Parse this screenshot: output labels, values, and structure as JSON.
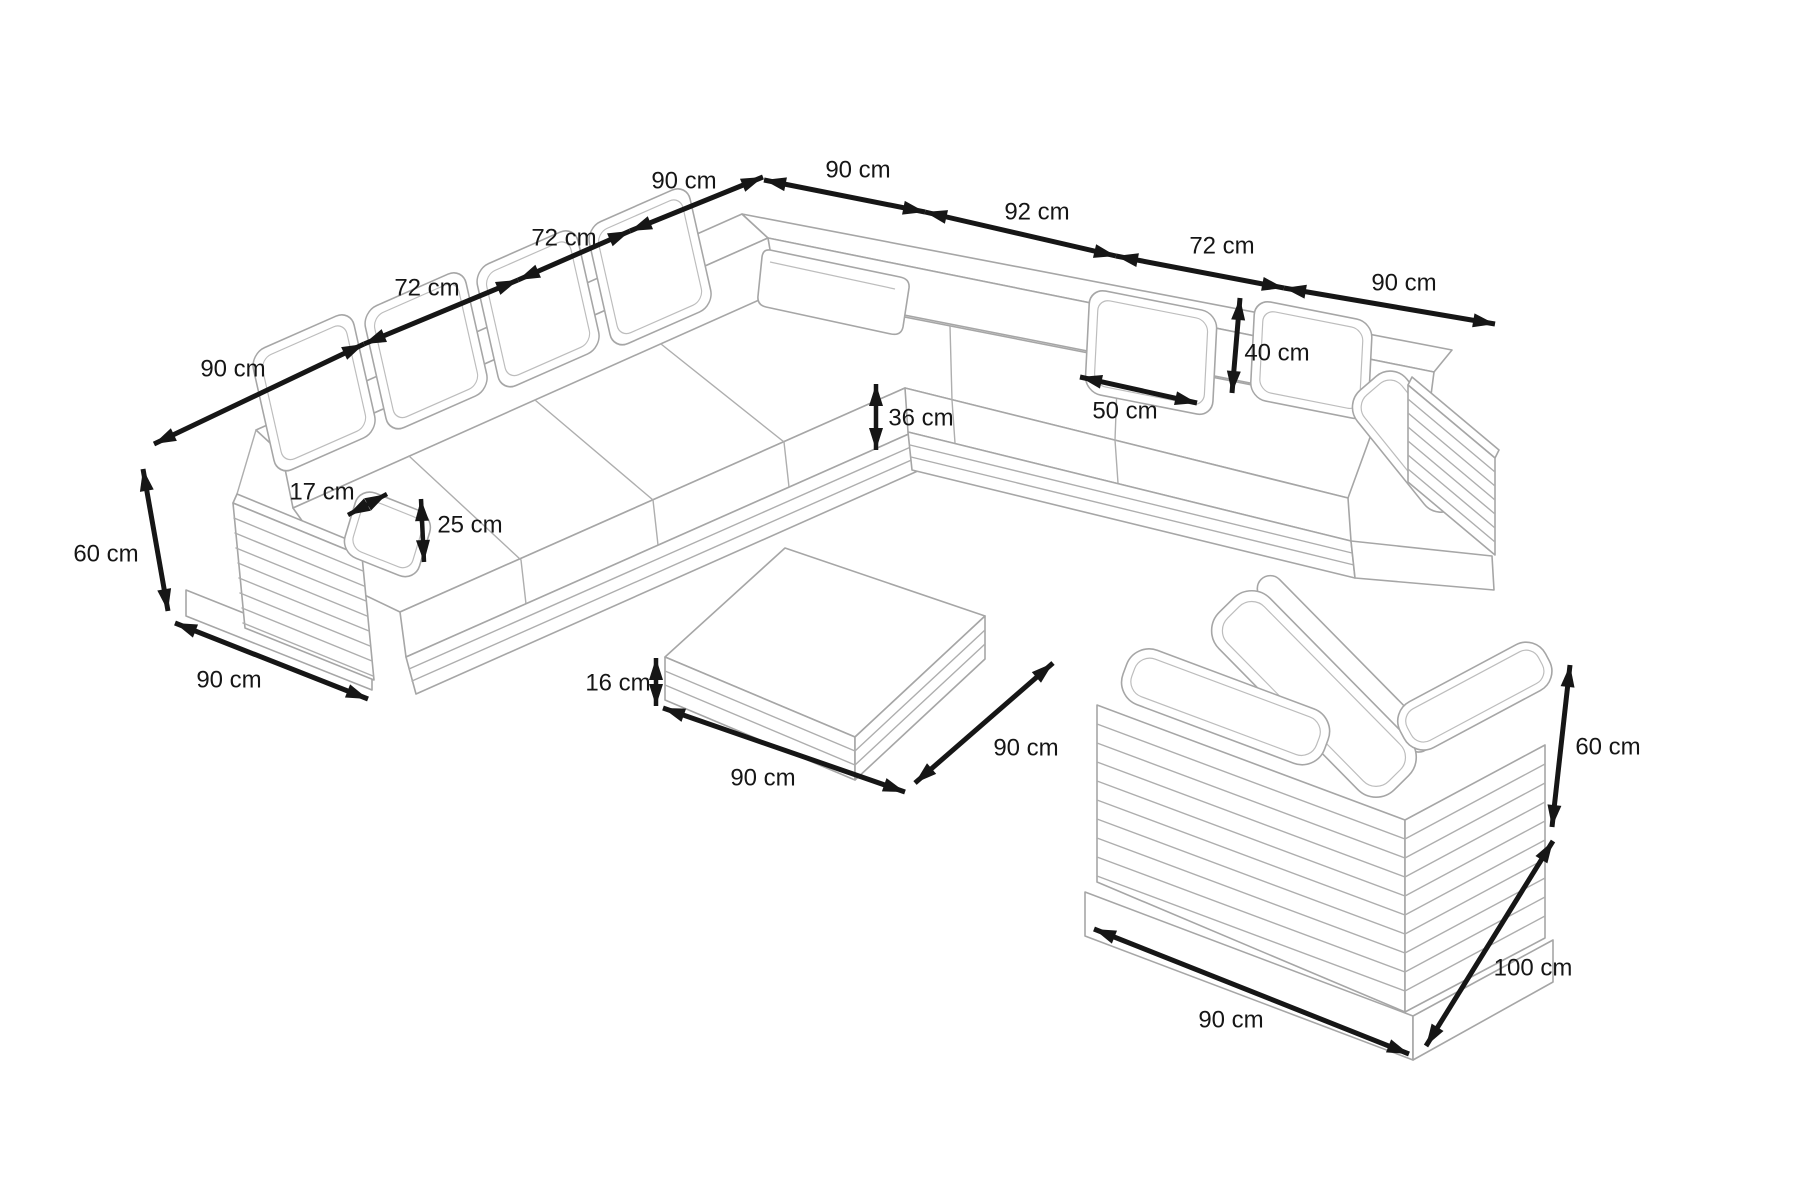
{
  "page": {
    "title": "Lounge furniture set dimension diagram",
    "background": "#ffffff"
  },
  "style": {
    "furniture_line_color": "#a6a6a6",
    "dimension_color": "#161616"
  },
  "unit": "cm",
  "furniture": {
    "corner_sofa": {
      "name": "corner sofa",
      "height_cm": 60,
      "end_depth_cm": 90,
      "seat_height_cm": 36,
      "back_left_segments_cm": [
        90,
        72,
        72,
        90
      ],
      "back_right_segments_cm": [
        90,
        92,
        72,
        90
      ],
      "armrest_cushion_width_cm": 17,
      "armrest_cushion_height_cm": 25,
      "back_cushion_width_cm": 50,
      "back_cushion_height_cm": 40
    },
    "coffee_table": {
      "name": "coffee table",
      "width_cm": 90,
      "depth_cm": 90,
      "height_cm": 16
    },
    "armchair": {
      "name": "armchair",
      "width_cm": 90,
      "depth_cm": 100,
      "height_cm": 60
    }
  },
  "labels": {
    "sofa_back_left_1": "90 cm",
    "sofa_back_left_2": "72 cm",
    "sofa_back_left_3": "72 cm",
    "sofa_back_left_4": "90 cm",
    "sofa_back_right_1": "90 cm",
    "sofa_back_right_2": "92 cm",
    "sofa_back_right_3": "72 cm",
    "sofa_back_right_4": "90 cm",
    "sofa_height": "60 cm",
    "sofa_depth": "90 cm",
    "armrest_width": "17 cm",
    "armrest_height": "25 cm",
    "seat_height": "36 cm",
    "cushion_width": "50 cm",
    "cushion_height": "40 cm",
    "table_height": "16 cm",
    "table_width": "90 cm",
    "table_depth": "90 cm",
    "armchair_height": "60 cm",
    "armchair_depth": "100 cm",
    "armchair_width": "90 cm"
  }
}
